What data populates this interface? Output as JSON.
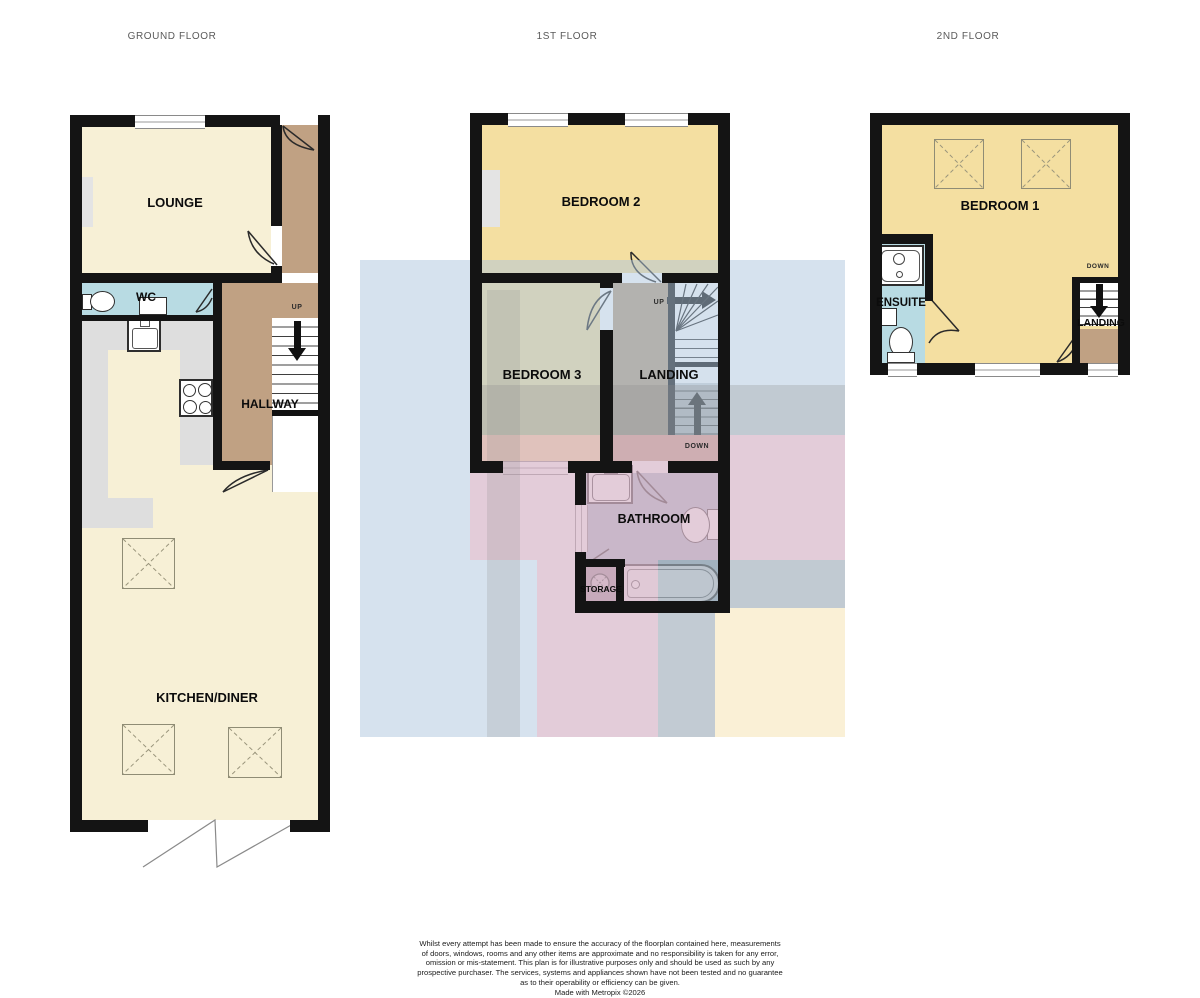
{
  "floors": [
    {
      "title": "GROUND FLOOR",
      "lounge": "LOUNGE",
      "wc": "WC",
      "hallway": "HALLWAY",
      "kitchen_diner": "KITCHEN/DINER",
      "up": "UP"
    },
    {
      "title": "1ST FLOOR",
      "bedroom2": "BEDROOM 2",
      "bedroom3": "BEDROOM 3",
      "landing": "LANDING",
      "bathroom": "BATHROOM",
      "storage": "STORAGE",
      "up": "UP",
      "down": "DOWN"
    },
    {
      "title": "2ND FLOOR",
      "bedroom1": "BEDROOM 1",
      "ensuite": "ENSUITE",
      "landing": "LANDING",
      "down": "DOWN"
    }
  ],
  "disclaimer_lines": [
    "Whilst every attempt has been made to ensure the accuracy of the floorplan contained here, measurements",
    "of doors, windows, rooms and any other items are approximate and no responsibility is taken for any error,",
    "omission or mis-statement. This plan is for illustrative purposes only and should be used as such by any",
    "prospective purchaser. The services, systems and appliances shown have not been tested and no guarantee",
    "as to their operability or efficiency can be given.",
    "Made with Metropix ©2026"
  ],
  "colors": {
    "room_cream": "#f7f0d6",
    "room_yellow": "#f4dfa1",
    "room_blue": "#b8dbe3",
    "hallway_tan": "#c0a183",
    "bathroom_blue_gray": "#a9bdc8",
    "storage_mauve": "#a3939c",
    "counter_gray": "#dedede",
    "wall_black": "#141414",
    "watermark_blue": "#aec6de",
    "watermark_pink": "#f9a8b7",
    "watermark_gray": "#8c8c8c",
    "watermark_cream": "#fcf0d4"
  }
}
